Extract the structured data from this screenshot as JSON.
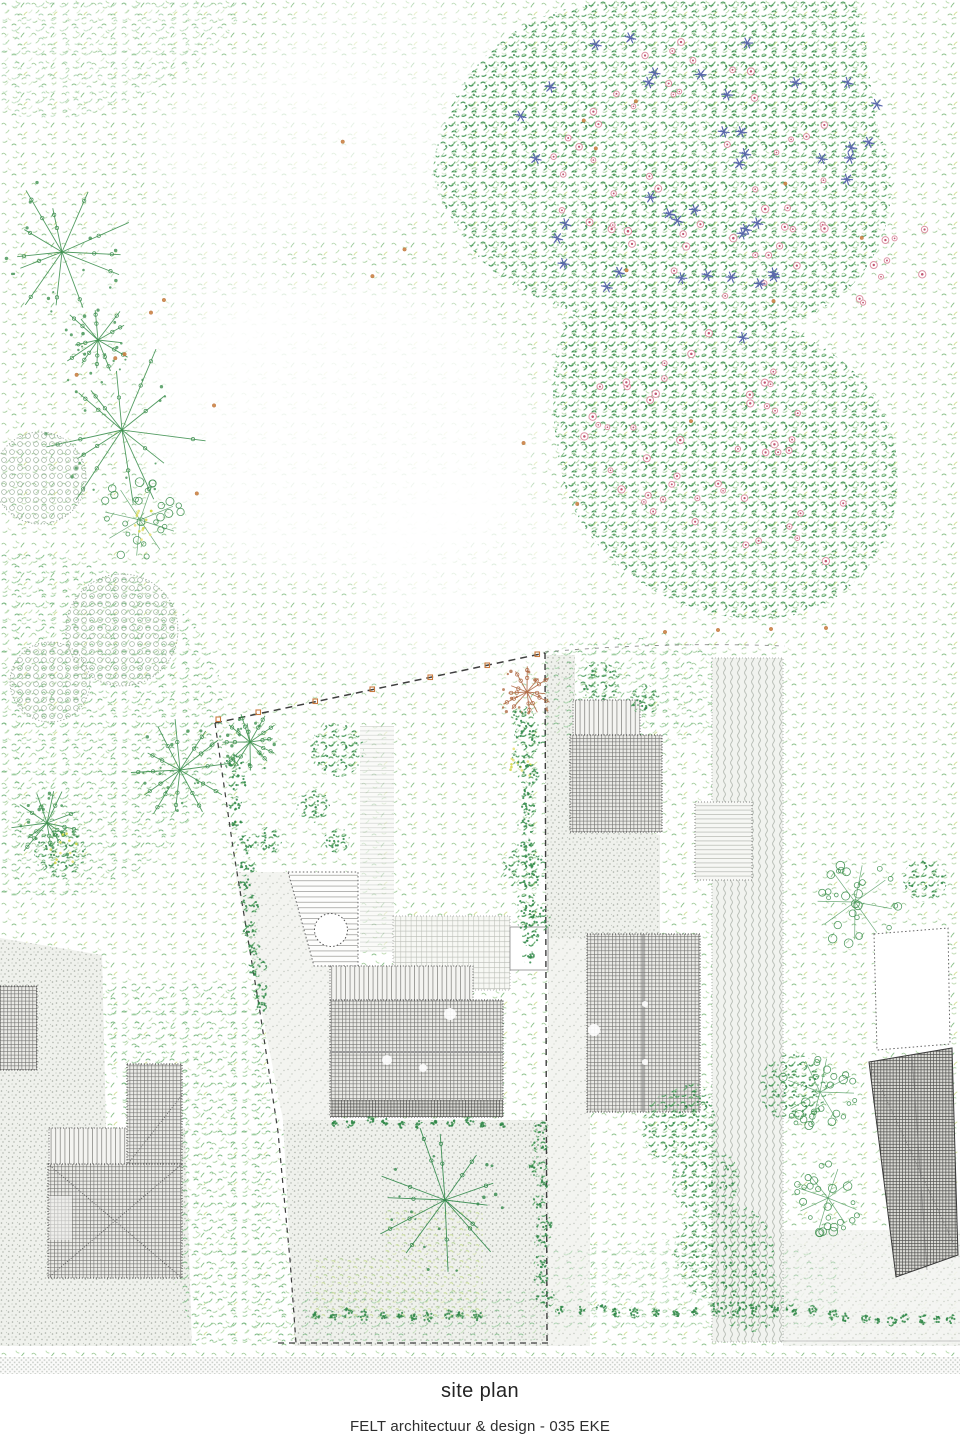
{
  "caption": {
    "title": "site plan"
  },
  "credit": {
    "line": "FELT architectuur & design - 035 EKE"
  },
  "drawing": {
    "type": "architectural landscape site plan"
  },
  "palette": {
    "meadow_green": "#a8cf9e",
    "foliage_green": "#4f9e61",
    "foliage_dark": "#2f8748",
    "tree_green": "#3f9150",
    "tree_brown": "#b06a44",
    "flower_pink": "#dc93a4",
    "flower_pink_dark": "#c25672",
    "flower_blue": "#5a68ac",
    "accent_orange": "#cd8244",
    "accent_yellow": "#d6d94e",
    "roof_line": "#5f5f5d",
    "paving_dot": "#a9b0a7",
    "boundary": "#3f3f3f",
    "caption_color": "#232323"
  }
}
